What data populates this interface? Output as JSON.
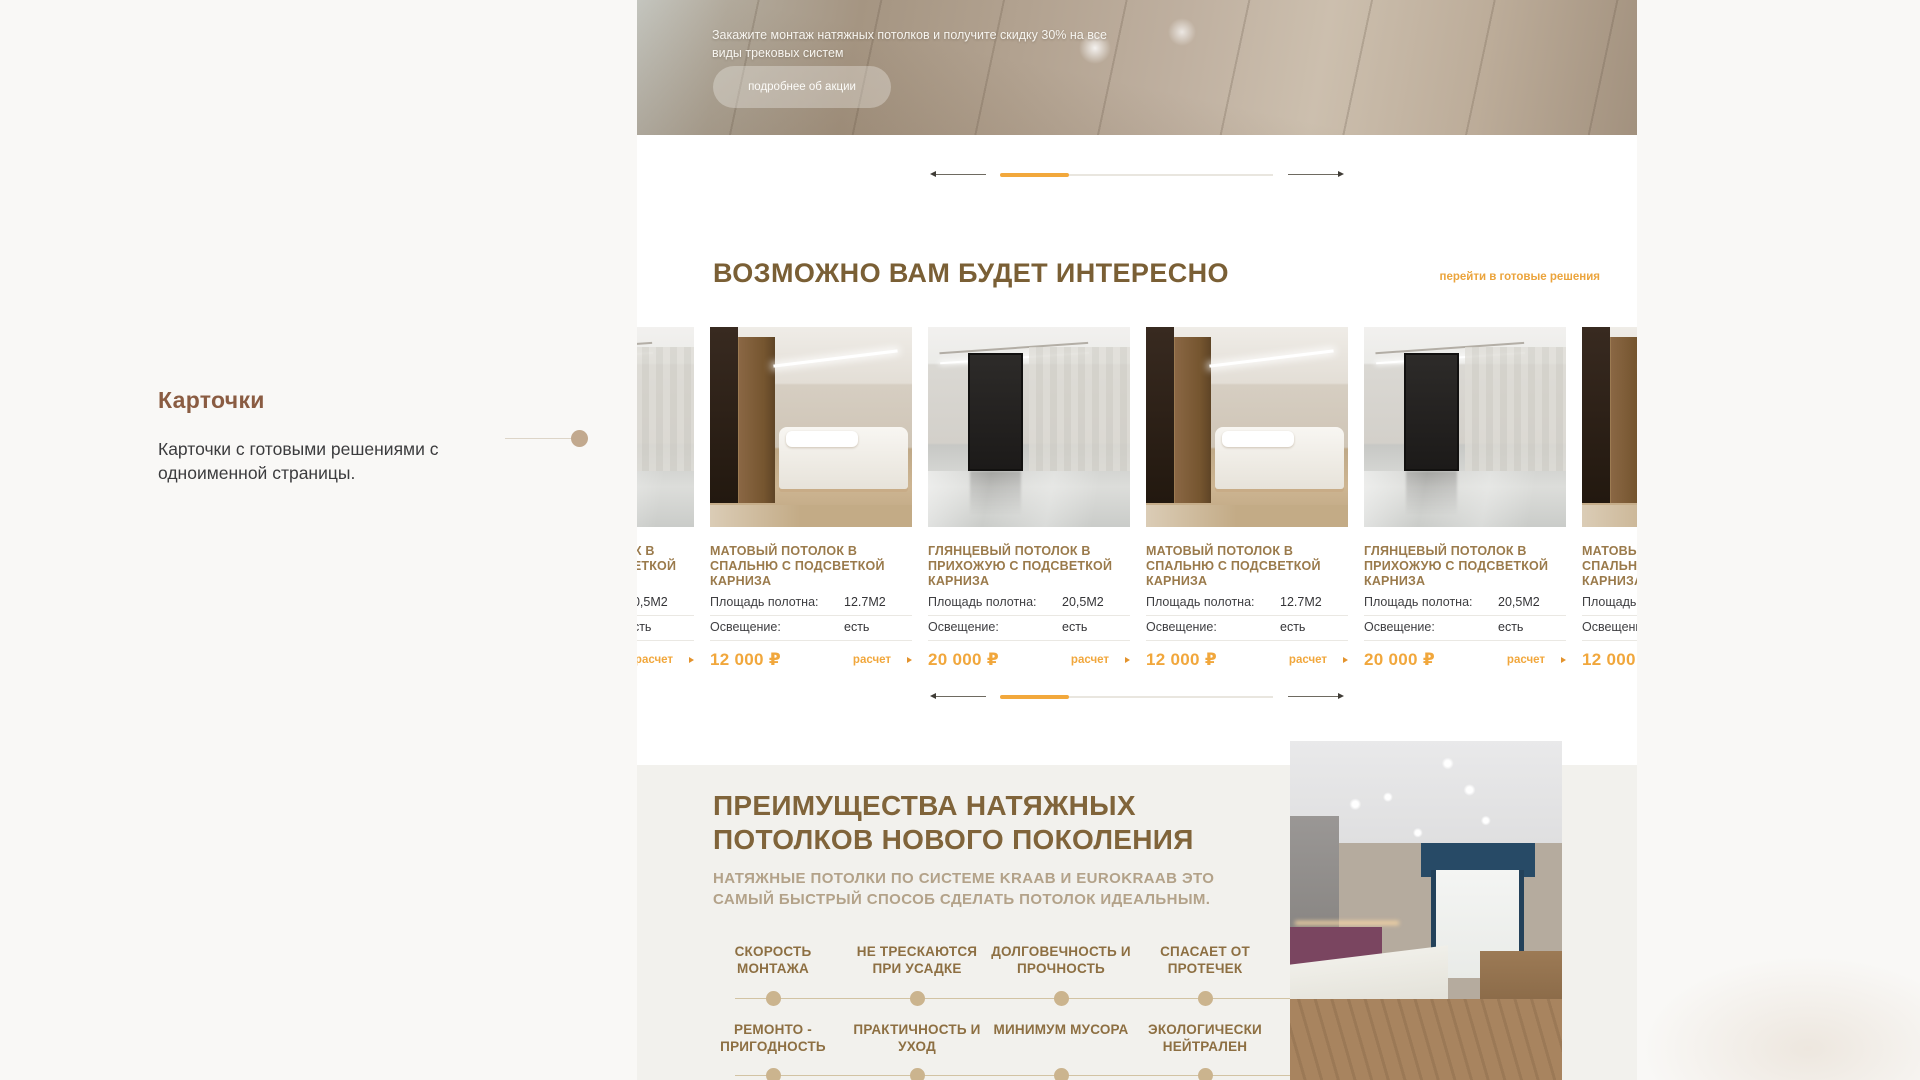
{
  "annotation": {
    "title": "Карточки",
    "description": "Карточки с готовыми решениями с одноименной страницы."
  },
  "site": {
    "hero": {
      "promo": "Закажите монтаж натяжных потолков и получите скидку 30% на все\nвиды трековых систем",
      "button_label": "подробнее об акции"
    },
    "cards_section": {
      "title": "ВОЗМОЖНО ВАМ БУДЕТ ИНТЕРЕСНО",
      "link_label": "перейти в готовые решения",
      "area_label": "Площадь полотна:",
      "light_label": "Освещение:",
      "calc_label": "расчет",
      "cards": [
        {
          "photo": "hallway-interior",
          "title": "ГЛЯНЦЕВЫЙ ПОТОЛОК В ПРИХОЖУЮ С ПОДСВЕТКОЙ КАРНИЗА",
          "area": "20,5М2",
          "light": "есть",
          "price": "20 000 ₽"
        },
        {
          "photo": "bedroom-interior",
          "title": "МАТОВЫЙ ПОТОЛОК В СПАЛЬНЮ С ПОДСВЕТКОЙ КАРНИЗА",
          "area": "12.7М2",
          "light": "есть",
          "price": "12 000 ₽"
        },
        {
          "photo": "hallway-interior",
          "title": "ГЛЯНЦЕВЫЙ ПОТОЛОК В ПРИХОЖУЮ С ПОДСВЕТКОЙ КАРНИЗА",
          "area": "20,5М2",
          "light": "есть",
          "price": "20 000 ₽"
        },
        {
          "photo": "bedroom-interior",
          "title": "МАТОВЫЙ ПОТОЛОК В СПАЛЬНЮ С ПОДСВЕТКОЙ КАРНИЗА",
          "area": "12.7М2",
          "light": "есть",
          "price": "12 000 ₽"
        },
        {
          "photo": "hallway-interior",
          "title": "ГЛЯНЦЕВЫЙ ПОТОЛОК В ПРИХОЖУЮ С ПОДСВЕТКОЙ КАРНИЗА",
          "area": "20,5М2",
          "light": "есть",
          "price": "20 000 ₽"
        },
        {
          "photo": "bedroom-interior",
          "title": "МАТОВЫЙ ПОТОЛОК В СПАЛЬНЮ С ПОДСВЕТКОЙ КАРНИЗА",
          "area": "12.7М2",
          "light": "есть",
          "price": "12 000 ₽"
        }
      ]
    },
    "benefits": {
      "title": "ПРЕИМУЩЕСТВА НАТЯЖНЫХ\nПОТОЛКОВ НОВОГО ПОКОЛЕНИЯ",
      "subtitle": "НАТЯЖНЫЕ ПОТОЛКИ ПО СИСТЕМЕ KRAAB И EUROKRAAB ЭТО\nСАМЫЙ БЫСТРЫЙ СПОСОБ СДЕЛАТЬ ПОТОЛОК ИДЕАЛЬНЫМ.",
      "features_row1": [
        "СКОРОСТЬ МОНТАЖА",
        "НЕ ТРЕСКАЮТСЯ ПРИ УСАДКЕ",
        "ДОЛГОВЕЧНОСТЬ И ПРОЧНОСТЬ",
        "СПАСАЕТ ОТ ПРОТЕЧЕК"
      ],
      "features_row2": [
        "РЕМОНТО - ПРИГОДНОСТЬ",
        "ПРАКТИЧНОСТЬ И УХОД",
        "МИНИМУМ МУСОРА",
        "ЭКОЛОГИЧЕСКИ НЕЙТРАЛЕН"
      ]
    }
  },
  "colors": {
    "accent_orange": "#f2a83c",
    "heading_brown": "#7a5f35",
    "card_title_brown": "#9a7a4b",
    "annotation_brown": "#8a5c42",
    "subtitle_tan": "#b3a289",
    "timeline_dot_tan": "#cbb48e",
    "section_bg": "#f2f1ed"
  }
}
